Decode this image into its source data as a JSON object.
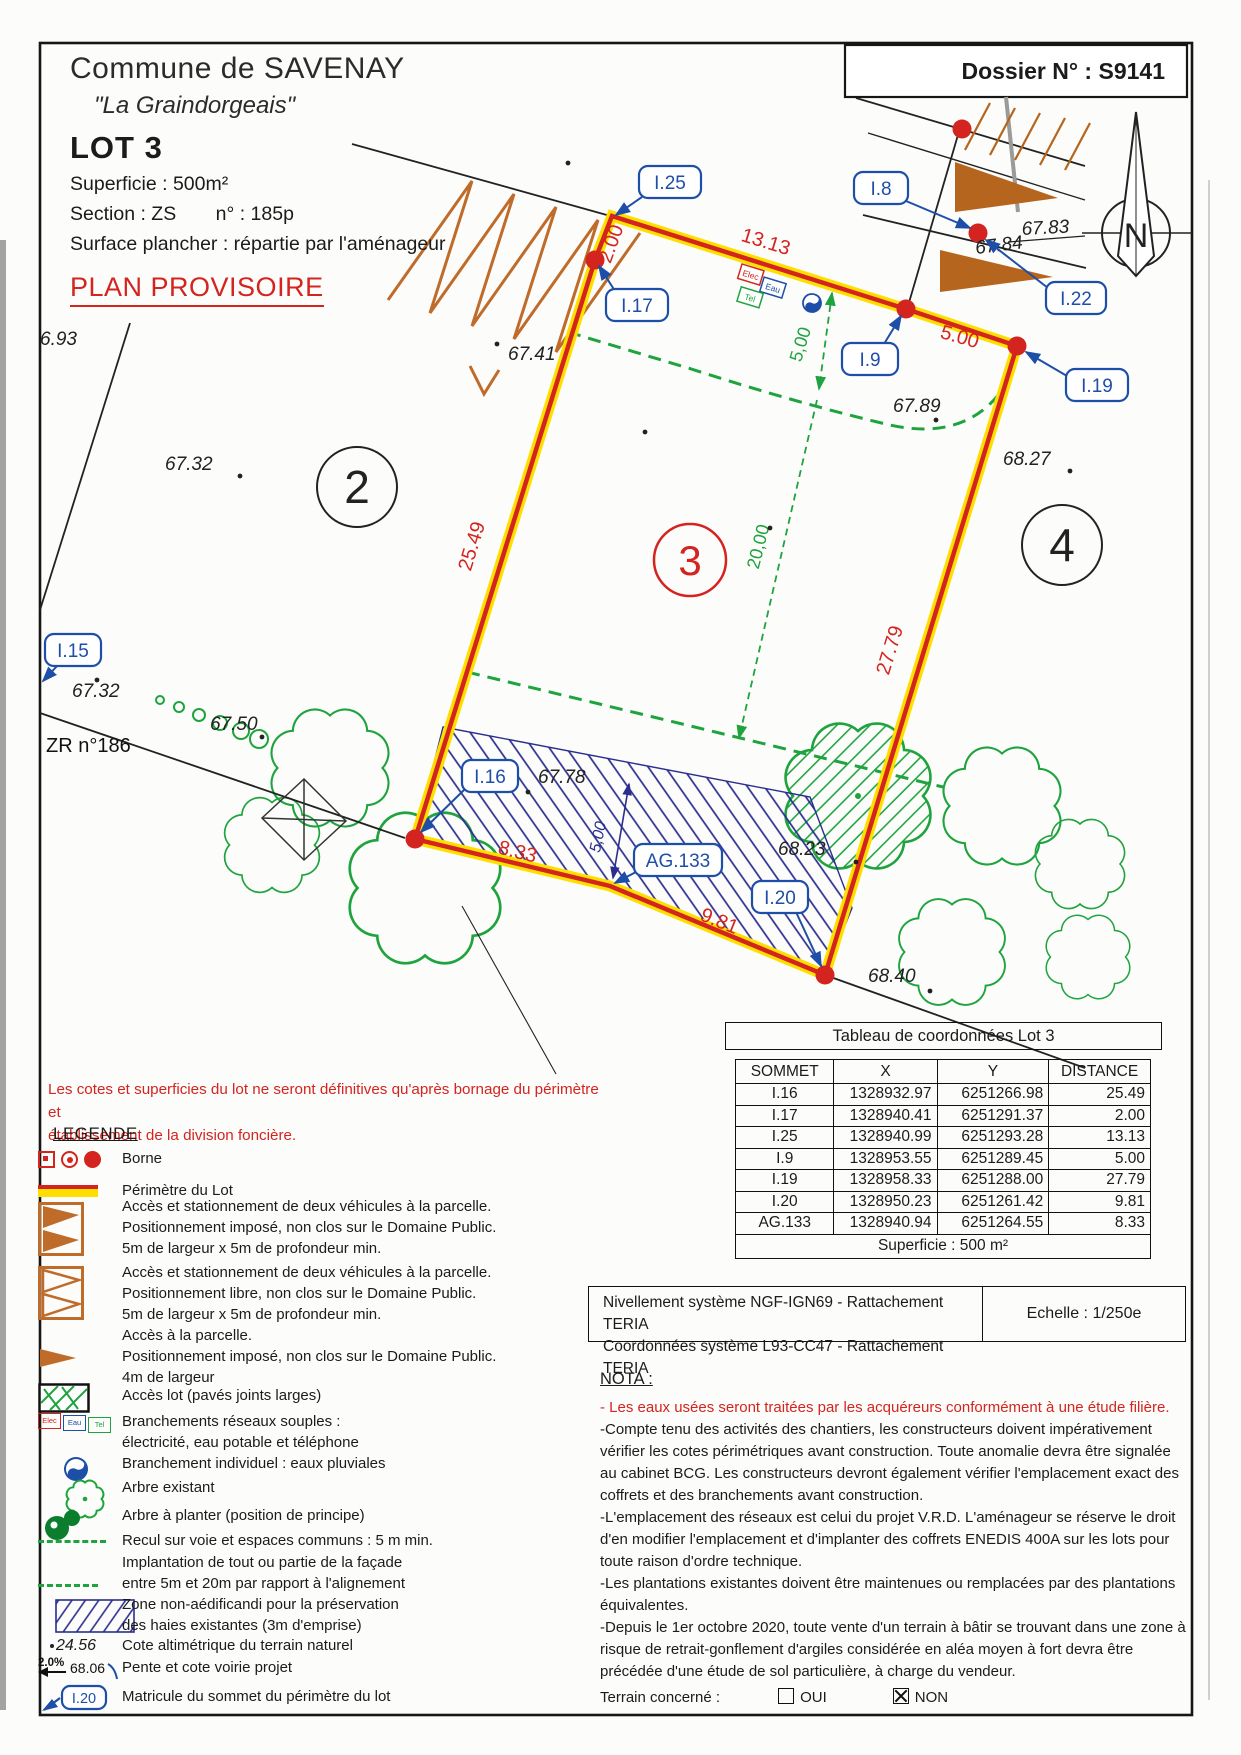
{
  "colors": {
    "red": "#d42420",
    "yellow": "#ffdf00",
    "blue": "#1d4ea8",
    "dark_blue": "#2b2e8f",
    "green": "#1ea33e",
    "dark_green": "#0b7d2c",
    "orange": "#bf6b2a",
    "brown": "#b5651d"
  },
  "header": {
    "commune": "Commune de SAVENAY",
    "lieu_dit": "\"La Graindorgeais\"",
    "lot": "LOT 3",
    "superficie": "Superficie : 500m²",
    "section": "Section : ZS",
    "section_numero": "n° : 185p",
    "surface_plancher": "Surface plancher : répartie par l'aménageur",
    "plan_provisoire": "PLAN PROVISOIRE",
    "dossier": "Dossier N° : S9141"
  },
  "plan": {
    "matricules": {
      "i8": "I.8",
      "i9": "I.9",
      "i15": "I.15",
      "i16": "I.16",
      "i17": "I.17",
      "i19": "I.19",
      "i20": "I.20",
      "i22": "I.22",
      "i25": "I.25",
      "ag133": "AG.133"
    },
    "dimensions_red": {
      "west": "25.49",
      "north_short": "2.00",
      "north": "13.13",
      "northeast": "5.00",
      "east": "27.79",
      "south_east": "9.81",
      "south_west": "8.33"
    },
    "dimensions_green": {
      "recul": "5,00",
      "implantation": "20,00"
    },
    "dimension_blue": {
      "haie": "5,00"
    },
    "elevations": {
      "far_west": "6.93",
      "west_upper": "67.32",
      "west_lower": "67.32",
      "south_west": "67.50",
      "north_west": "67.41",
      "north_east_1": "67.83",
      "north_east_2": "67.84",
      "inside_north": "67.89",
      "inside_south": "67.78",
      "south_mid": "68.23",
      "east": "68.27",
      "south_corner": "68.40"
    },
    "parcelles": {
      "p2": "2",
      "p3": "3",
      "p4": "4"
    },
    "zr": "ZR n°186",
    "reseaux": {
      "elec": "Elec",
      "eau": "Eau",
      "tel": "Tel"
    },
    "north": "N"
  },
  "table": {
    "title": "Tableau de coordonnées Lot 3",
    "columns": [
      "SOMMET",
      "X",
      "Y",
      "DISTANCE"
    ],
    "rows": [
      [
        "I.16",
        "1328932.97",
        "6251266.98",
        "25.49"
      ],
      [
        "I.17",
        "1328940.41",
        "6251291.37",
        "2.00"
      ],
      [
        "I.25",
        "1328940.99",
        "6251293.28",
        "13.13"
      ],
      [
        "I.9",
        "1328953.55",
        "6251289.45",
        "5.00"
      ],
      [
        "I.19",
        "1328958.33",
        "6251288.00",
        "27.79"
      ],
      [
        "I.20",
        "1328950.23",
        "6251261.42",
        "9.81"
      ],
      [
        "AG.133",
        "1328940.94",
        "6251264.55",
        "8.33"
      ]
    ],
    "footer": "Superficie : 500 m²"
  },
  "georef": {
    "line1": "Nivellement système NGF-IGN69 - Rattachement TERIA",
    "line2": "Coordonnées système L93-CC47  - Rattachement TERIA",
    "echelle": "Echelle : 1/250e"
  },
  "note_red": {
    "line1": "Les cotes et superficies du lot ne seront définitives qu'après bornage du périmètre et",
    "line2": "établissement de la division foncière."
  },
  "legend": {
    "title": "LEGENDE",
    "items": [
      {
        "lines": [
          "Borne"
        ]
      },
      {
        "lines": [
          "Périmètre du Lot"
        ]
      },
      {
        "lines": [
          "Accès et stationnement de deux véhicules à la parcelle.",
          "Positionnement imposé, non clos sur le Domaine Public.",
          "5m de largeur x 5m de profondeur min."
        ]
      },
      {
        "lines": [
          "Accès et stationnement de deux véhicules à la parcelle.",
          "Positionnement libre, non clos sur le Domaine Public.",
          "5m de largeur x 5m de profondeur min."
        ]
      },
      {
        "lines": [
          "Accès à la parcelle.",
          "Positionnement imposé, non clos sur le Domaine Public.",
          "4m de largeur"
        ]
      },
      {
        "lines": [
          "Accès lot (pavés joints larges)"
        ]
      },
      {
        "lines": [
          "Branchements réseaux souples :",
          "électricité, eau potable et téléphone"
        ]
      },
      {
        "lines": [
          "Branchement individuel : eaux pluviales"
        ]
      },
      {
        "lines": [
          "Arbre existant"
        ]
      },
      {
        "lines": [
          "Arbre à planter (position de principe)"
        ]
      },
      {
        "lines": [
          "Recul sur voie et espaces communs : 5 m min."
        ]
      },
      {
        "lines": [
          "Implantation de tout ou partie de la façade",
          "entre 5m et 20m par rapport à l'alignement"
        ]
      },
      {
        "lines": [
          "Zone non-aédificandi pour la préservation",
          "des haies existantes (3m d'emprise)"
        ]
      },
      {
        "value": "24.56",
        "lines": [
          "Cote altimétrique du terrain naturel"
        ]
      },
      {
        "pente": "2.0%",
        "cote": "68.06",
        "lines": [
          "Pente et cote voirie projet"
        ]
      },
      {
        "tag": "I.20",
        "lines": [
          "Matricule du sommet du périmètre du lot"
        ]
      }
    ]
  },
  "nota": {
    "title": "NOTA :",
    "red_line": "- Les eaux usées seront traitées par les acquéreurs conformément à une étude filière.",
    "lines": [
      "-Compte tenu des activités des chantiers, les constructeurs doivent impérativement",
      "vérifier les cotes périmétriques avant construction. Toute anomalie devra être signalée",
      "au cabinet BCG. Les constructeurs devront également vérifier l'emplacement exact des",
      "coffrets et des branchements avant construction.",
      "-L'emplacement des réseaux est celui du projet V.R.D. L'aménageur se réserve le droit",
      "d'en modifier l'emplacement et d'implanter des coffrets ENEDIS 400A sur les lots pour",
      "toute raison d'ordre technique.",
      "-Les plantations existantes doivent être maintenues ou remplacées par des plantations",
      "équivalentes.",
      "-Depuis le 1er octobre 2020, toute vente d'un terrain à bâtir se trouvant dans une zone à",
      "risque de retrait-gonflement d'argiles considérée en aléa moyen à fort devra être",
      "précédée d'une étude de sol particulière, à charge du vendeur."
    ],
    "terrain_label": "Terrain concerné :",
    "oui": "OUI",
    "non": "NON",
    "oui_checked": false,
    "non_checked": true
  }
}
